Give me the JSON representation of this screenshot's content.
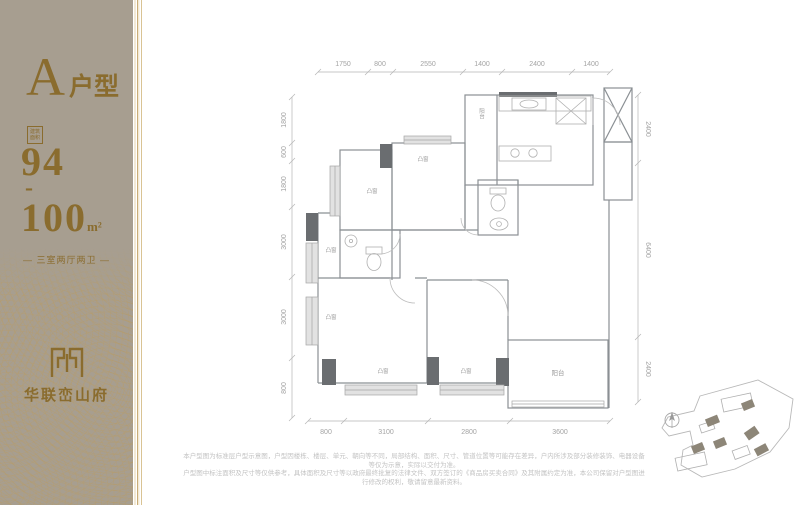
{
  "brand": {
    "name": "华联峦山府"
  },
  "sidebar": {
    "unit_letter": "A",
    "unit_type_suffix": "户型",
    "area_badge": {
      "line1": "建筑",
      "line2": "面积"
    },
    "area_min": "94",
    "area_dash": "-",
    "area_max": "100",
    "area_unit": "m²",
    "layout_summary": "— 三室两厅两卫 —"
  },
  "floor_plan": {
    "dims_top": [
      "1750",
      "800",
      "2550",
      "1400",
      "2400",
      "1400"
    ],
    "dims_bottom": [
      "800",
      "3100",
      "2800",
      "3600"
    ],
    "dims_left_top_to_bottom": [
      "1800",
      "600",
      "1800",
      "3000",
      "3000",
      "800"
    ],
    "dims_right_top_to_bottom": [
      "2400",
      "6400",
      "2400"
    ],
    "labels": {
      "bay_window": "凸窗",
      "balcony": "阳台"
    }
  },
  "footer": {
    "disclaimer_line1": "本户型图为标准层户型示意图，户型因楼栋、楼层、单元、朝向等不同，局部结构、面积、尺寸、管道位置等可能存在差异，户内所涉及部分装修装饰、电器设备等仅为示意，实际以交付为准。",
    "disclaimer_line2": "户型图中标注面积及尺寸等仅供参考，具体面积及尺寸等以政府最终批复的法律文件、双方签订的《商品房买卖合同》及其附属约定为准，本公司保留对户型图进行修改的权利，敬请留意最新资料。"
  },
  "colors": {
    "sidebar_bg": "#a79e90",
    "brand_gold": "#8a6c2e",
    "wall_dark": "#6a6d70",
    "dim_text": "#a3a3a3"
  }
}
